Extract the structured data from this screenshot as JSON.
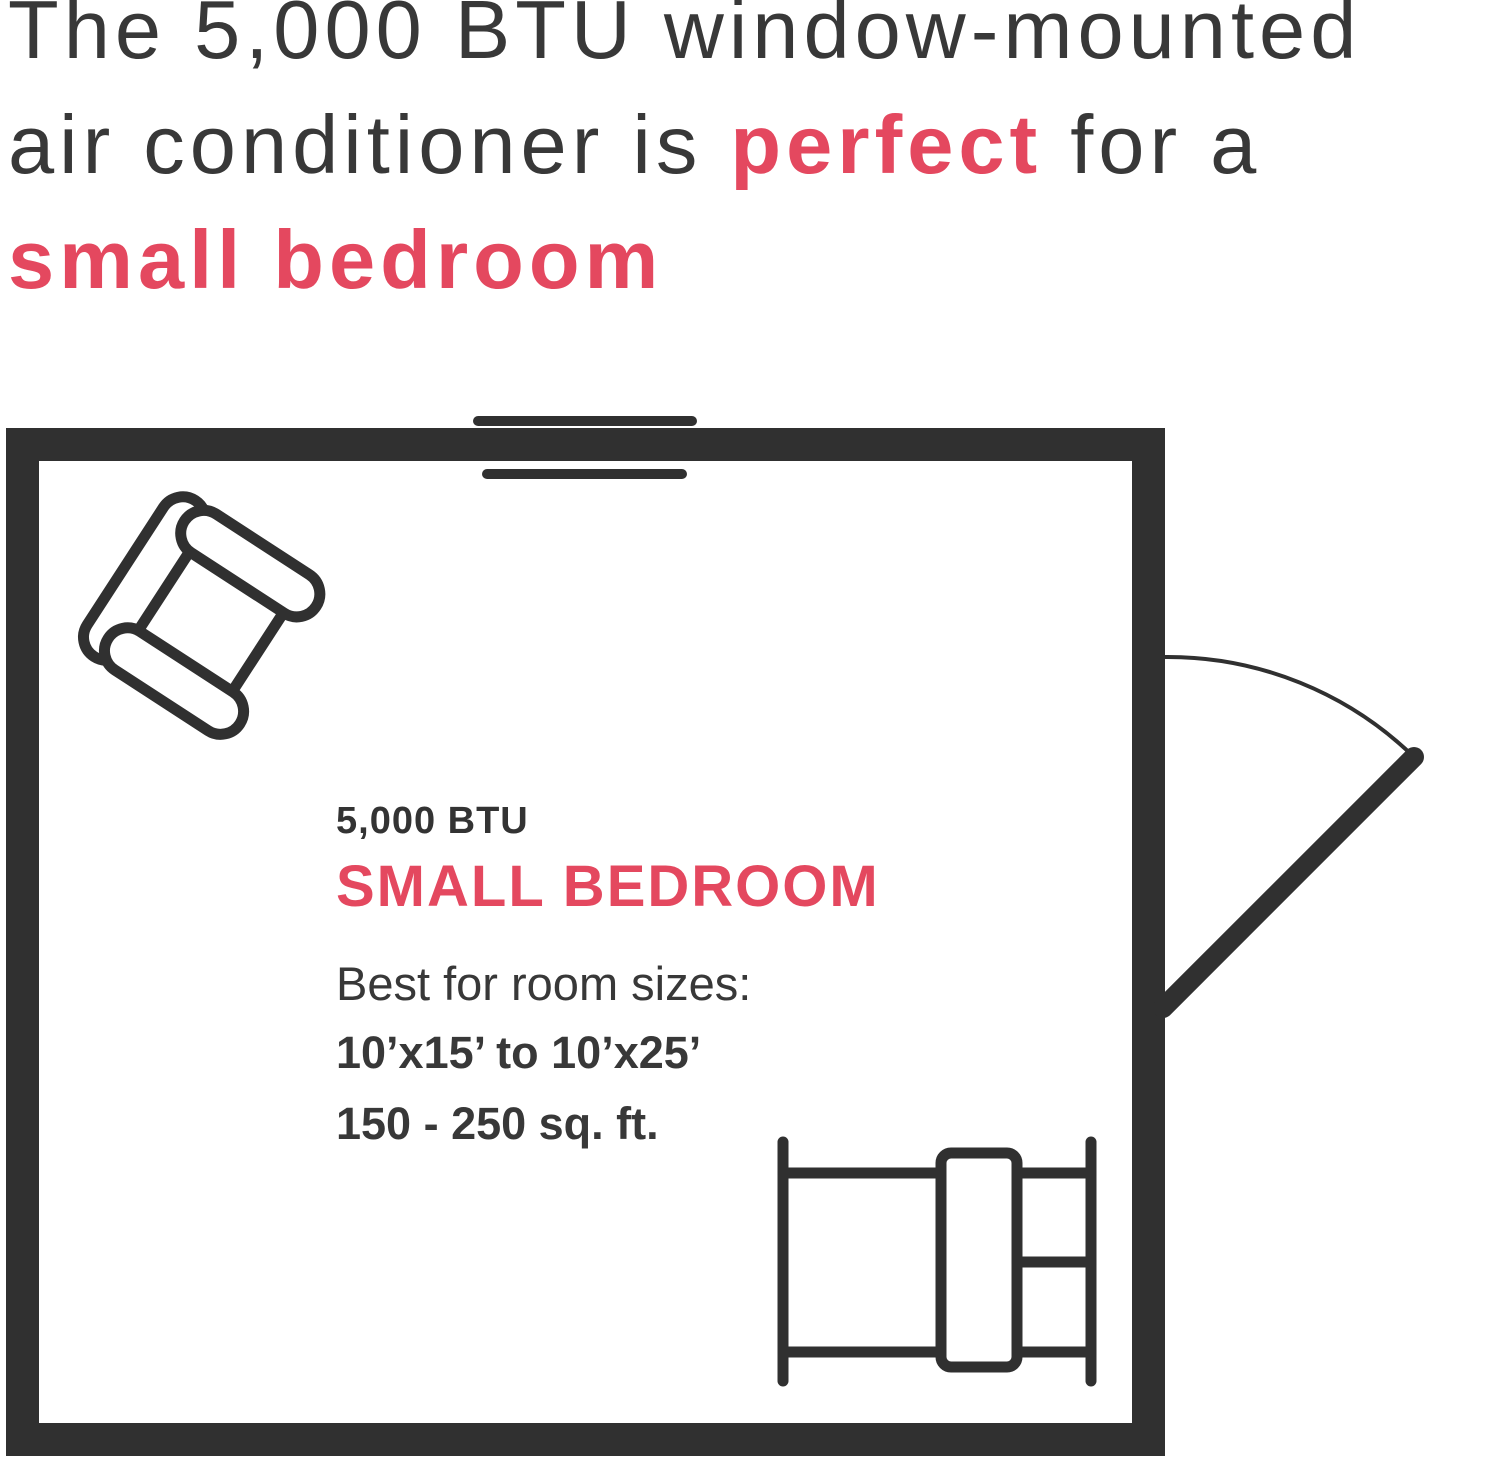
{
  "colors": {
    "accent": "#E4485F",
    "ink": "#303030"
  },
  "headline": {
    "line1": "The 5,000 BTU window-mounted",
    "line2_before": "air conditioner is ",
    "line2_accent": "perfect",
    "line2_after": " for a",
    "line3_accent": "small bedroom"
  },
  "room_label": {
    "btu": "5,000 BTU",
    "room_type": "SMALL BEDROOM",
    "subtitle": "Best for room sizes:",
    "dimensions": "10’x15’ to 10’x25’",
    "area": "150 - 250 sq. ft."
  },
  "floorplan": {
    "icons": [
      "room-wall-outline",
      "window-icon",
      "armchair-icon",
      "door-swing-icon",
      "bed-icon"
    ]
  }
}
